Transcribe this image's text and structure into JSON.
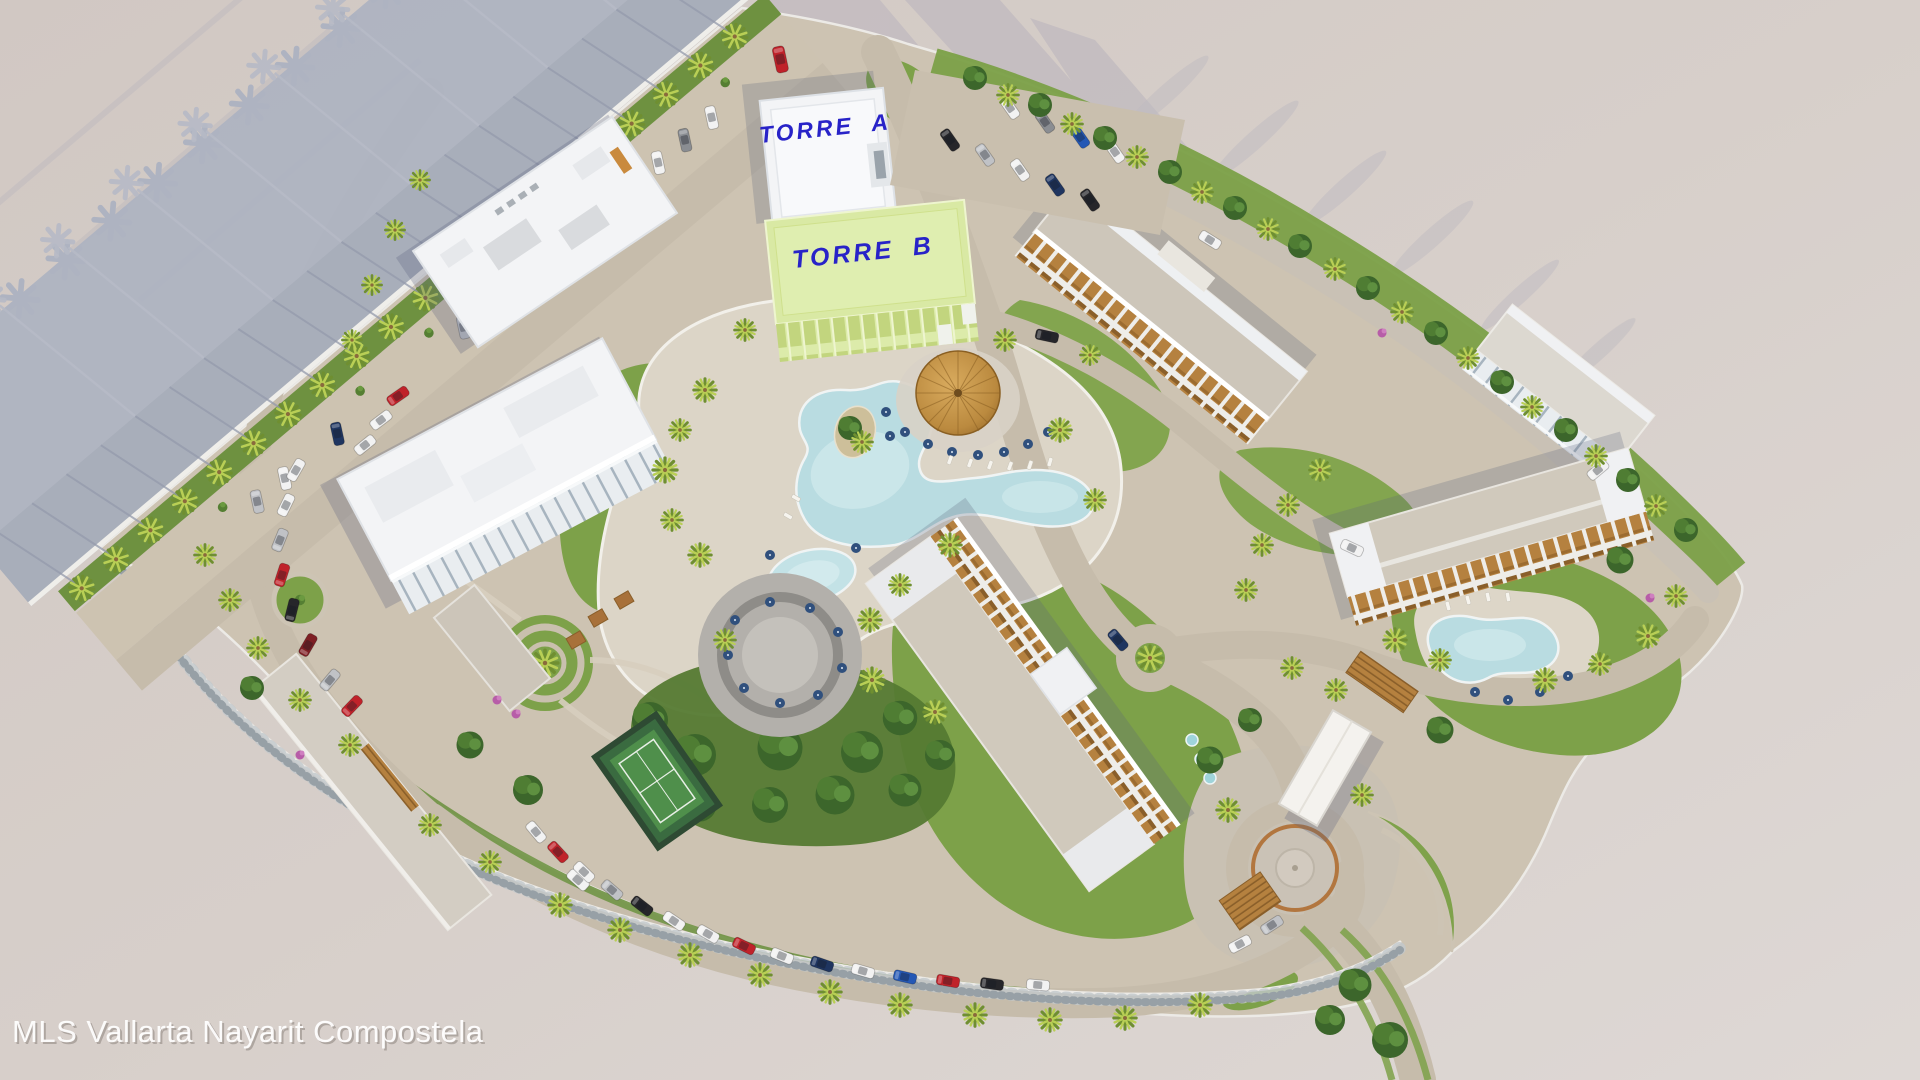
{
  "scene": {
    "labels": {
      "tower_a": "TORRE A",
      "tower_b": "TORRE B"
    },
    "watermark": "MLS Vallarta Nayarit Compostela",
    "palette": {
      "background": "#d5cdc8",
      "cast_shadow": "#aeb3c1",
      "street_shadowed": "#a8aeba",
      "wall_white": "#efeeea",
      "lawn": "#7da149",
      "lawn_bright": "#83a54f",
      "hedge_dark": "#557a33",
      "palm_bright": "#b9cf55",
      "palm_dark": "#6f8f31",
      "sand": "#cdc3b2",
      "road": "#c6bcab",
      "pool_water": "#b9dce1",
      "pool_deck": "#dcd5c7",
      "palapa_thatch": "#c99a4e",
      "roof_white": "#f3f4f6",
      "roof_green_torre_b": "#d9e9a4",
      "roof_beige": "#d0c9bc",
      "balcony_wood": "#b5813f",
      "umbrella_blue": "#30507d",
      "label_blue": "#2823c8",
      "car_red": "#c0222a",
      "car_blue": "#2458b5",
      "car_white": "#f2f2f2",
      "car_black": "#26262a"
    },
    "features": [
      "torre-a-tower",
      "torre-b-tower",
      "lagoon-pool",
      "round-pool",
      "east-pool",
      "palapa-bar",
      "restaurant-terrace",
      "spa-circle-garden",
      "tennis-court",
      "entrance-canopy",
      "entrance-plaza",
      "crescent-lawn",
      "palm-lined-street",
      "parking-areas",
      "perimeter-road"
    ]
  }
}
